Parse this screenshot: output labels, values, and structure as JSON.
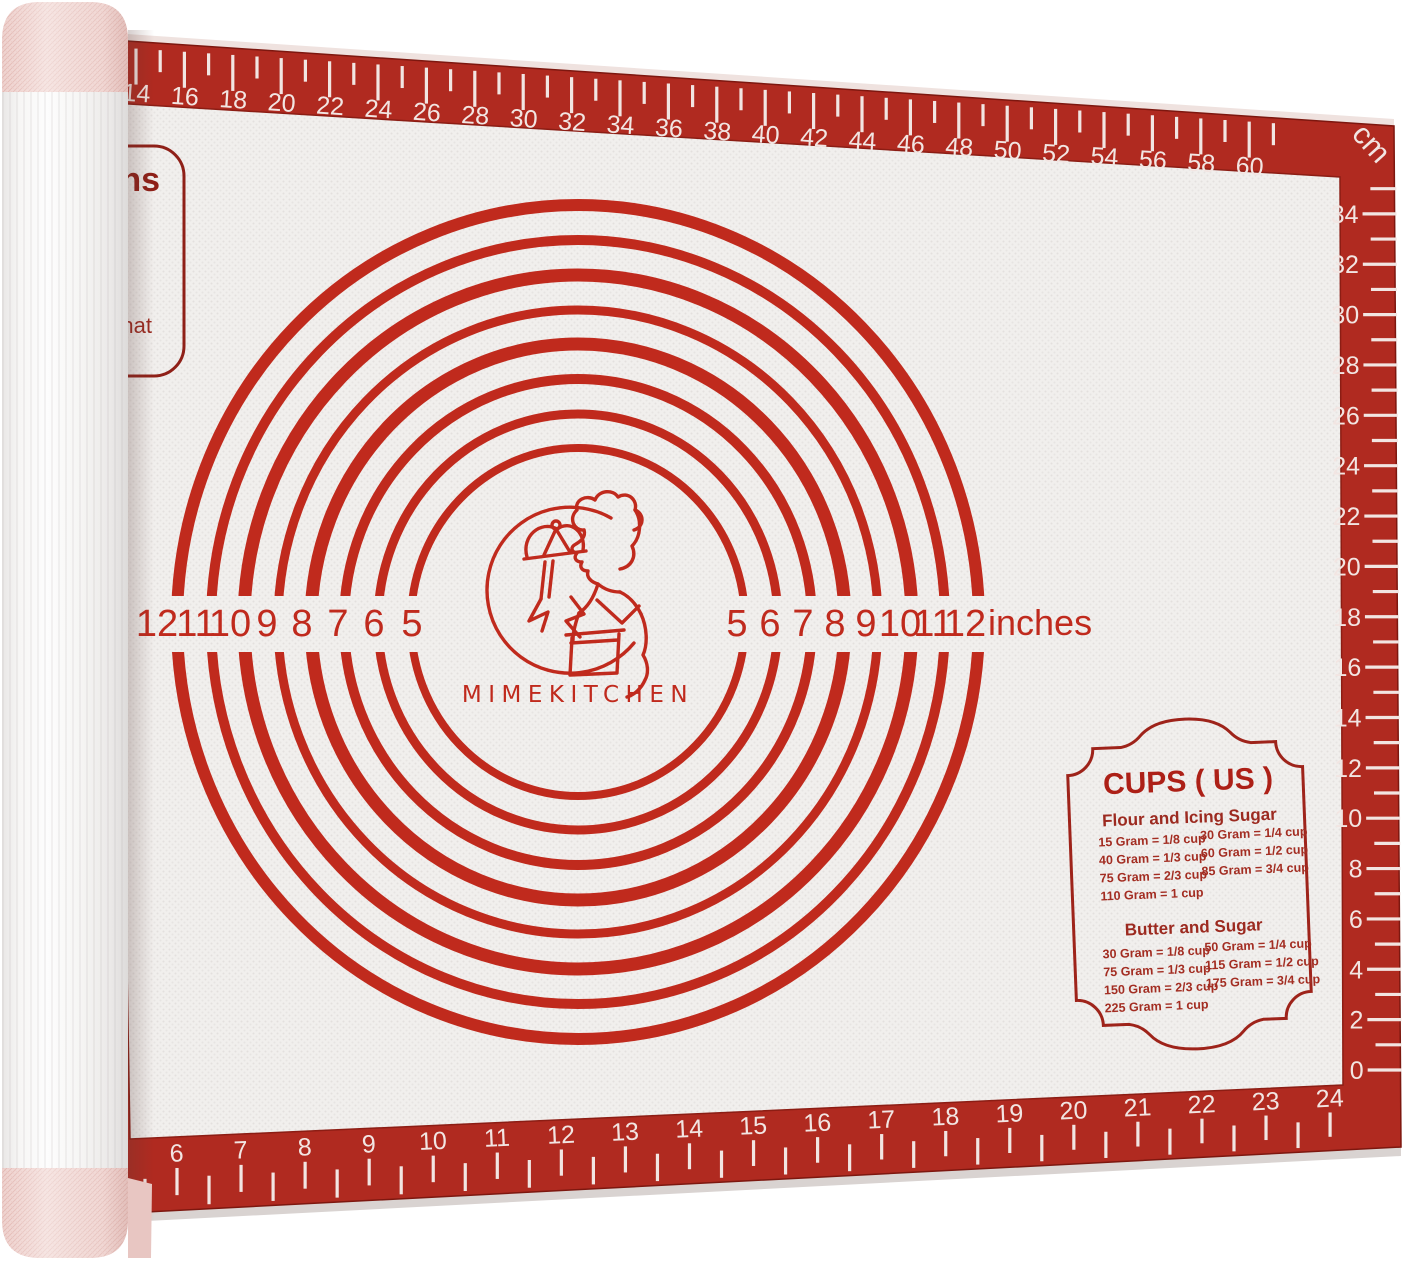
{
  "brand": "MIMEKITCHEN",
  "colors": {
    "border_red": "#b02a20",
    "marking_red": "#c02a1d",
    "dark_red": "#8f2018",
    "mat_white": "#f1efed",
    "roll_pink": "#e9c9c5",
    "tick_cream": "#f2e5e2"
  },
  "dial": {
    "left_labels": [
      "12",
      "11",
      "10",
      "9",
      "8",
      "7",
      "6",
      "5"
    ],
    "right_labels": [
      "5",
      "6",
      "7",
      "8",
      "9",
      "10",
      "11",
      "12"
    ],
    "unit": "inches"
  },
  "rulers": {
    "cm_unit": "cm",
    "top_cm": {
      "labels": [
        "14",
        "16",
        "18",
        "20",
        "22",
        "24",
        "26",
        "28",
        "30",
        "32",
        "34",
        "36",
        "38",
        "40",
        "42",
        "44",
        "46",
        "48",
        "50",
        "52",
        "54",
        "56",
        "58",
        "60"
      ]
    },
    "right_cm": {
      "labels": [
        "34",
        "32",
        "30",
        "28",
        "26",
        "24",
        "22",
        "20",
        "18",
        "16",
        "14",
        "12",
        "10",
        "8",
        "6",
        "4",
        "2",
        "0"
      ]
    },
    "bottom_in": {
      "labels": [
        "6",
        "7",
        "8",
        "9",
        "10",
        "11",
        "12",
        "13",
        "14",
        "15",
        "16",
        "17",
        "18",
        "19",
        "20",
        "21",
        "22",
        "23",
        "24"
      ]
    }
  },
  "corner_box": {
    "line1": "ns",
    "line2": "nat"
  },
  "cups_panel": {
    "title": "CUPS ( US )",
    "sections": [
      {
        "heading": "Flour and Icing Sugar",
        "rows_left": [
          "15 Gram = 1/8 cup",
          "40 Gram = 1/3 cup",
          "75 Gram = 2/3 cup",
          "110 Gram =   1 cup"
        ],
        "rows_right": [
          "30 Gram = 1/4 cup",
          "60 Gram = 1/2 cup",
          "85 Gram = 3/4 cup"
        ]
      },
      {
        "heading": "Butter and Sugar",
        "rows_left": [
          "30 Gram = 1/8 cup",
          "75 Gram = 1/3 cup",
          "150 Gram = 2/3 cup",
          "225 Gram =    1 cup"
        ],
        "rows_right": [
          "50 Gram = 1/4 cup",
          "115 Gram = 1/2 cup",
          "175 Gram = 3/4 cup"
        ]
      }
    ]
  }
}
